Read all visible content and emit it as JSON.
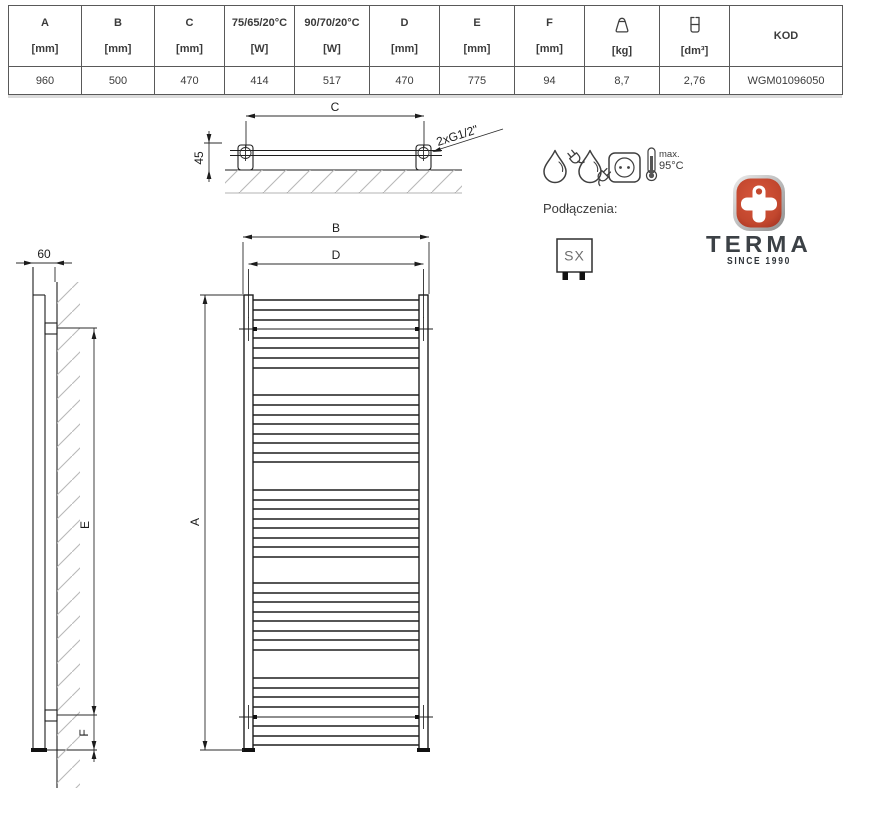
{
  "table": {
    "columns": [
      {
        "label": "A",
        "unit": "[mm]",
        "value": "960"
      },
      {
        "label": "B",
        "unit": "[mm]",
        "value": "500"
      },
      {
        "label": "C",
        "unit": "[mm]",
        "value": "470"
      },
      {
        "label": "75/65/20°C",
        "unit": "[W]",
        "value": "414"
      },
      {
        "label": "90/70/20°C",
        "unit": "[W]",
        "value": "517"
      },
      {
        "label": "D",
        "unit": "[mm]",
        "value": "470"
      },
      {
        "label": "E",
        "unit": "[mm]",
        "value": "775"
      },
      {
        "label": "F",
        "unit": "[mm]",
        "value": "94"
      },
      {
        "label": "",
        "icon": "weight-icon",
        "unit": "[kg]",
        "value": "8,7"
      },
      {
        "label": "",
        "icon": "volume-icon",
        "unit": "[dm³]",
        "value": "2,76"
      },
      {
        "label": "KOD",
        "unit": "",
        "value": "WGM01096050"
      }
    ]
  },
  "dimensions": {
    "top_c": "C",
    "top_offset": "45",
    "thread": "2xG1/2\"",
    "front_b": "B",
    "front_d": "D",
    "front_a": "A",
    "side_depth": "60",
    "side_e": "E",
    "side_f": "F"
  },
  "features": {
    "thermometer_line1": "max.",
    "thermometer_line2": "95°C"
  },
  "connections": {
    "label": "Podłączenia:",
    "type": "SX"
  },
  "logo": {
    "name": "TERMA",
    "tagline": "SINCE 1990",
    "red": "#c2472e"
  }
}
